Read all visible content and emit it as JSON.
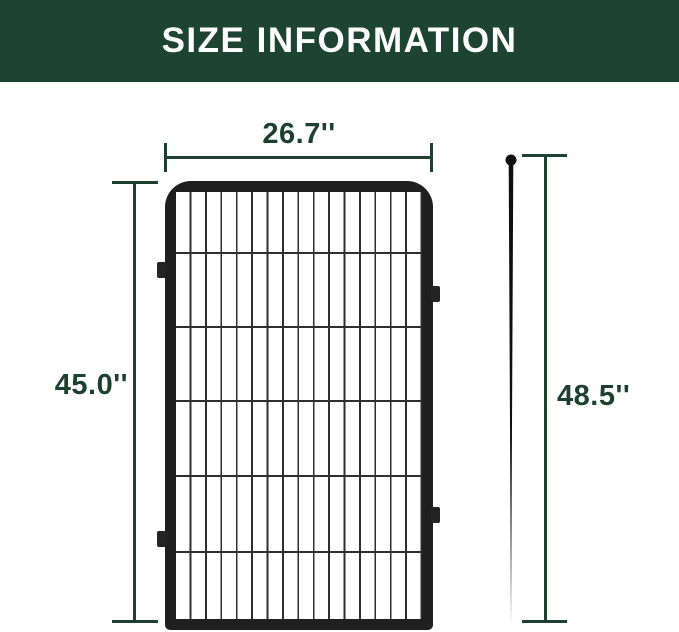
{
  "header": {
    "title": "SIZE INFORMATION",
    "background_color": "#1d4333",
    "text_color": "#ffffff"
  },
  "diagram": {
    "accent_color": "#1d4031",
    "panel": {
      "name": "wire fence panel",
      "frame_color": "#1f1f1f",
      "wire_color": "#2f2f2f",
      "width_label": "26.7''",
      "height_label": "45.0''"
    },
    "stake": {
      "name": "ground stake",
      "color": "#0f0f0f",
      "height_label": "48.5''"
    }
  }
}
